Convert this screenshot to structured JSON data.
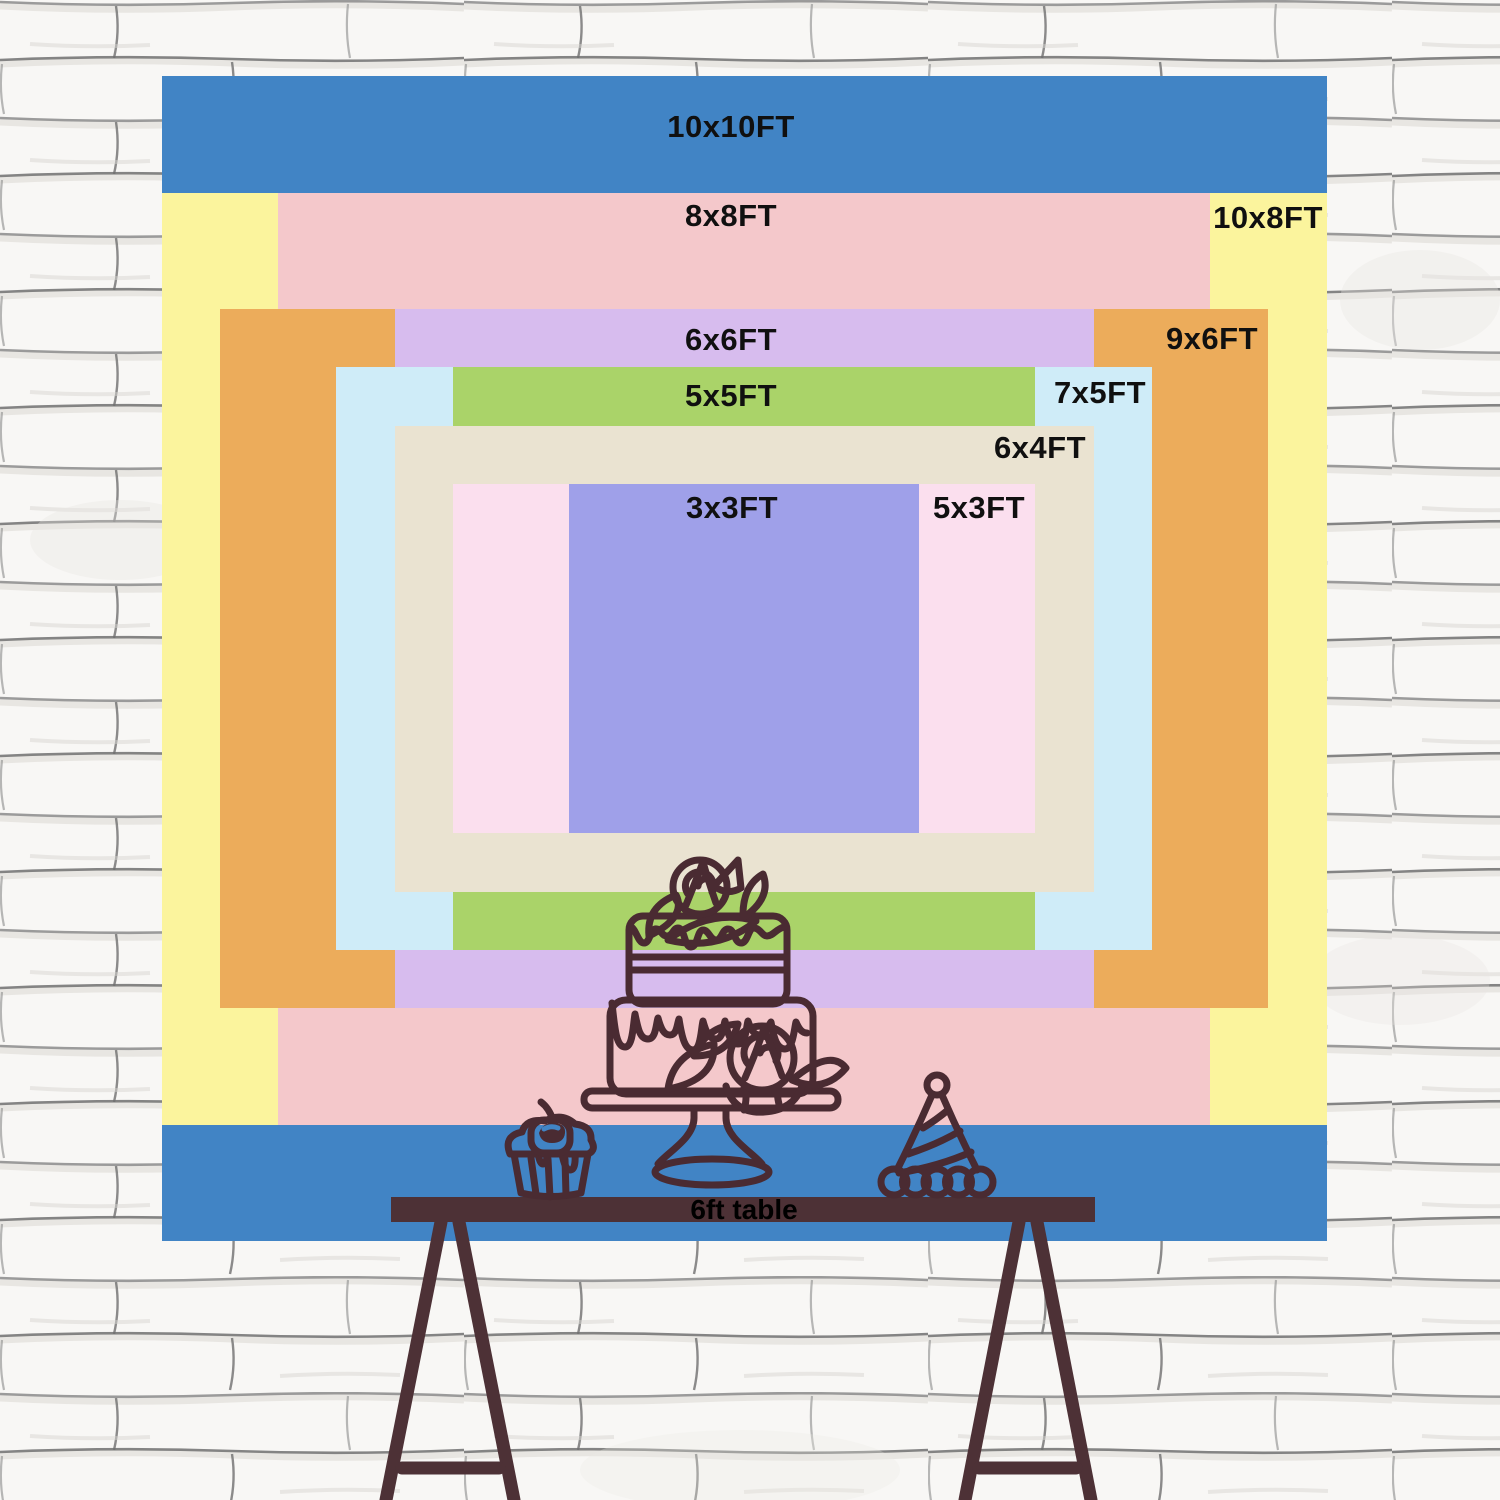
{
  "title": "Backdrop size comparison chart",
  "scale_px_per_ft": 116.5,
  "center": {
    "x": 744,
    "y": 658.5
  },
  "sizes": [
    {
      "id": "10x10",
      "label": "10x10FT",
      "width_ft": 10,
      "height_ft": 10,
      "color": "#4184c5",
      "label_cx": 731,
      "label_cy": 127
    },
    {
      "id": "10x8",
      "label": "10x8FT",
      "width_ft": 10,
      "height_ft": 8,
      "color": "#fbf49d",
      "label_cx": 1268,
      "label_cy": 218
    },
    {
      "id": "8x8",
      "label": "8x8FT",
      "width_ft": 8,
      "height_ft": 8,
      "color": "#f4c8cb",
      "label_cx": 731,
      "label_cy": 216
    },
    {
      "id": "9x6",
      "label": "9x6FT",
      "width_ft": 9,
      "height_ft": 6,
      "color": "#ecac5b",
      "label_cx": 1212,
      "label_cy": 339
    },
    {
      "id": "6x6",
      "label": "6x6FT",
      "width_ft": 6,
      "height_ft": 6,
      "color": "#d7bcee",
      "label_cx": 731,
      "label_cy": 340
    },
    {
      "id": "7x5",
      "label": "7x5FT",
      "width_ft": 7,
      "height_ft": 5,
      "color": "#cfecf8",
      "label_cx": 1100,
      "label_cy": 393
    },
    {
      "id": "5x5",
      "label": "5x5FT",
      "width_ft": 5,
      "height_ft": 5,
      "color": "#aad369",
      "label_cx": 731,
      "label_cy": 396
    },
    {
      "id": "6x4",
      "label": "6x4FT",
      "width_ft": 6,
      "height_ft": 4,
      "color": "#eae3d1",
      "label_cx": 1040,
      "label_cy": 448
    },
    {
      "id": "5x3",
      "label": "5x3FT",
      "width_ft": 5,
      "height_ft": 3,
      "color": "#fbdfee",
      "label_cx": 979,
      "label_cy": 508
    },
    {
      "id": "3x3",
      "label": "3x3FT",
      "width_ft": 3,
      "height_ft": 3,
      "color": "#9fa0e9",
      "label_cx": 732,
      "label_cy": 508
    }
  ],
  "table": {
    "label": "6ft table",
    "color": "#4d3136"
  },
  "illustration": {
    "line_color": "#4a2b32",
    "items": [
      "birthday-cake",
      "cupcake",
      "party-hat"
    ]
  },
  "wall": {
    "background": "#f8f7f5",
    "mortar_line": "#8b8b8b"
  }
}
